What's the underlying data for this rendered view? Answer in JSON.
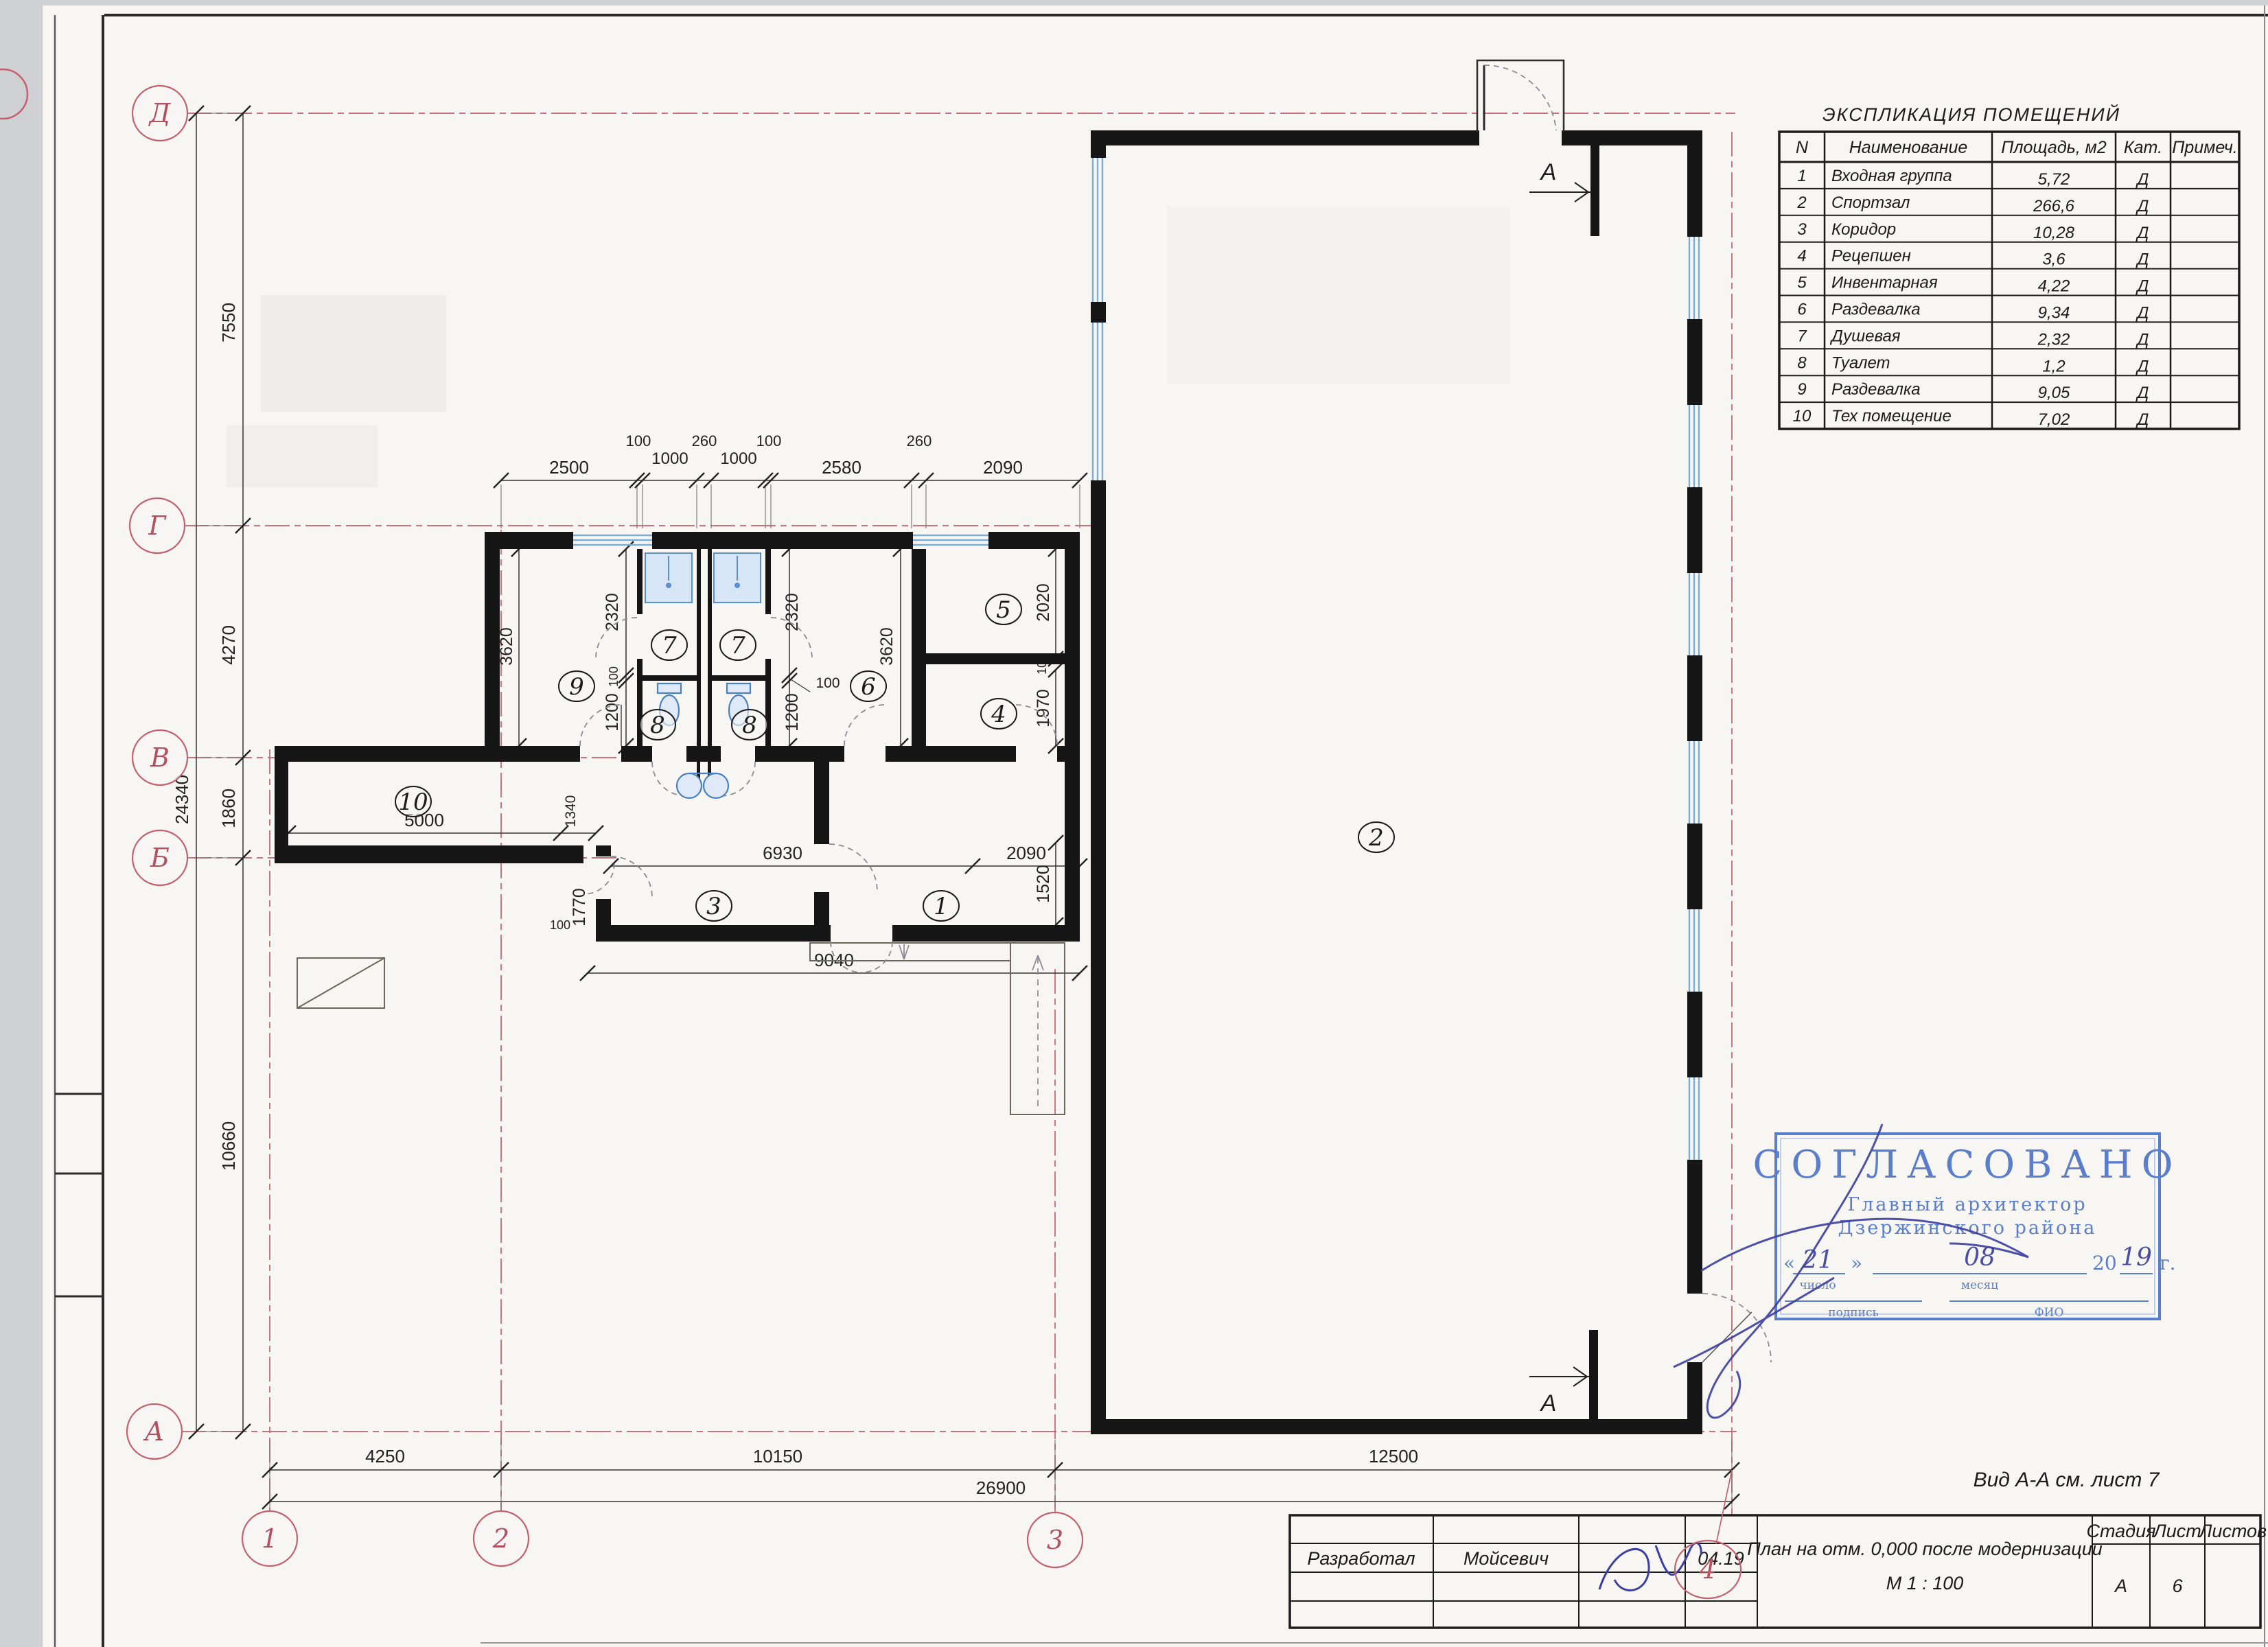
{
  "sheet": {
    "view_note": "Вид А-А см. лист 7"
  },
  "explication": {
    "title": "ЭКСПЛИКАЦИЯ ПОМЕЩЕНИЙ",
    "headers": {
      "n": "N",
      "name": "Наименование",
      "area": "Площадь, м2",
      "cat": "Кат.",
      "note": "Примеч."
    },
    "rows": [
      {
        "n": "1",
        "name": "Входная группа",
        "area": "5,72",
        "cat": "Д"
      },
      {
        "n": "2",
        "name": "Спортзал",
        "area": "266,6",
        "cat": "Д"
      },
      {
        "n": "3",
        "name": "Коридор",
        "area": "10,28",
        "cat": "Д"
      },
      {
        "n": "4",
        "name": "Рецепшен",
        "area": "3,6",
        "cat": "Д"
      },
      {
        "n": "5",
        "name": "Инвентарная",
        "area": "4,22",
        "cat": "Д"
      },
      {
        "n": "6",
        "name": "Раздевалка",
        "area": "9,34",
        "cat": "Д"
      },
      {
        "n": "7",
        "name": "Душевая",
        "area": "2,32",
        "cat": "Д"
      },
      {
        "n": "8",
        "name": "Туалет",
        "area": "1,2",
        "cat": "Д"
      },
      {
        "n": "9",
        "name": "Раздевалка",
        "area": "9,05",
        "cat": "Д"
      },
      {
        "n": "10",
        "name": "Тех помещение",
        "area": "7,02",
        "cat": "Д"
      }
    ]
  },
  "stamp": {
    "title": "СОГЛАСОВАНО",
    "line1": "Главный архитектор",
    "line2": "Дзержинского района",
    "quote_open": "«",
    "quote_close": "»",
    "day_hand": "21",
    "month_hand": "08",
    "year_prefix": "20",
    "year_hand": "19",
    "year_suffix": "г.",
    "label_day": "число",
    "label_month": "месяц",
    "label_sign": "подпись",
    "label_fio": "ФИО"
  },
  "titleblock": {
    "developed_label": "Разработал",
    "developed_name": "Мойсевич",
    "date": "04.19",
    "doc_title": "План на отм. 0,000 после модернизации",
    "scale": "М 1 : 100",
    "stage_label": "Стадия",
    "sheet_label": "Лист",
    "sheets_label": "Листов",
    "stage_value": "А",
    "sheet_value": "6",
    "sheets_value": ""
  },
  "plan": {
    "section_mark": "А",
    "axes": {
      "d": "Д",
      "g": "Г",
      "v": "В",
      "b": "Б",
      "a": "А",
      "n1": "1",
      "n2": "2",
      "n3": "3",
      "n4": "4"
    },
    "rooms": {
      "r1": "1",
      "r2": "2",
      "r3": "3",
      "r4": "4",
      "r5": "5",
      "r6": "6",
      "r7a": "7",
      "r7b": "7",
      "r8a": "8",
      "r8b": "8",
      "r9": "9",
      "r10": "10"
    },
    "dims": {
      "t2500": "2500",
      "t100a": "100",
      "t1000a": "1000",
      "t260a": "260",
      "t1000b": "1000",
      "t100b": "100",
      "t2580": "2580",
      "t260b": "260",
      "t2090": "2090",
      "b4250": "4250",
      "b10150": "10150",
      "b12500": "12500",
      "b26900": "26900",
      "l7550": "7550",
      "l4270": "4270",
      "l1860": "1860",
      "l10660": "10660",
      "l24340": "24340",
      "w2320a": "2320",
      "w2320b": "2320",
      "w3620a": "3620",
      "w3620b": "3620",
      "w2020": "2020",
      "w1970": "1970",
      "w1520": "1520",
      "w1200a": "1200",
      "w1200b": "1200",
      "w100a": "100",
      "w100b": "100",
      "w100c": "100",
      "w100d": "100",
      "w2090": "2090",
      "w6930": "6930",
      "w9040": "9040",
      "w5000": "5000",
      "w1340": "1340",
      "w1770": "1770"
    }
  }
}
